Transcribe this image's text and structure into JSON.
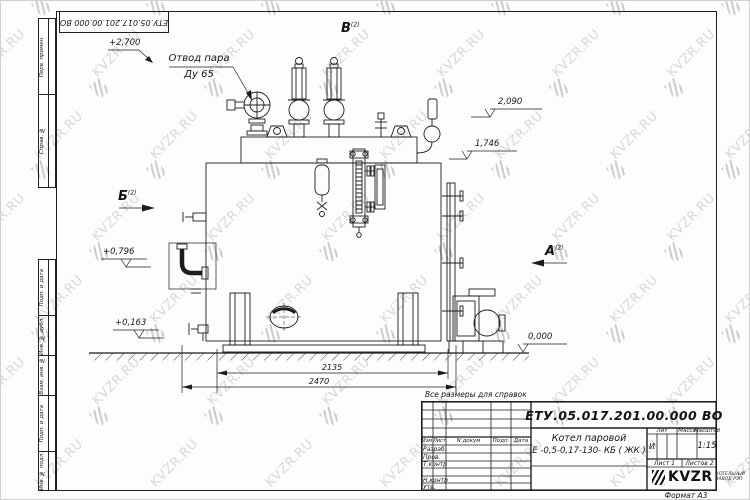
{
  "watermark": {
    "text": "KVZR.RU"
  },
  "stamp_top_box": {
    "number": "ЕТУ.05.017.201.00.000  ВО"
  },
  "side_fields": {
    "top": [
      "Перв. примен.",
      "Справ. №"
    ],
    "bottom": [
      "Подп. и дата",
      "Инв. № дубл.",
      "Взам. инв. №",
      "Подп. и дата",
      "Инв. № подл."
    ]
  },
  "annotations": {
    "steam_outlet_line1": "Отвод пара",
    "steam_outlet_line2": "Ду 65",
    "view_v": "В",
    "view_b": "Б",
    "view_a": "А",
    "view_sheet_ref": "(2)",
    "elev_2700": "+2,700",
    "elev_2090": "2,090",
    "elev_1746": "1,746",
    "elev_0796": "+0,796",
    "elev_0163": "+0,163",
    "elev_0000": "0,000",
    "dim_2135": "2135",
    "dim_2470": "2470",
    "ref_note": "Все размеры для справок"
  },
  "title_block": {
    "doc_number": "ЕТУ.05.017.201.00.000  ВО",
    "product_name_line1": "Котел паровой",
    "product_name_line2": "Е -0,5-0,17-130- КБ ( ЖК )",
    "col_izm": "Изм",
    "col_list": "Лист",
    "col_ndoc": "N докум",
    "col_podp": "Подп.",
    "col_data": "Дата",
    "rows": [
      "Разраб.",
      "Пров.",
      "Т.контр",
      "",
      "Н.контр",
      "Утв."
    ],
    "lit_label": "Лит",
    "massa_label": "Масса",
    "masshtab_label": "Масштаб",
    "lit_value": "И",
    "scale_value": "1:15",
    "sheet_label": "Лист 1",
    "sheets_label": "Листов 2",
    "logo_text": "KVZR",
    "logo_sub1": "КОТЕЛЬНЫЙ",
    "logo_sub2": "ЗАВОД РЭП",
    "format_label": "Формат А3"
  }
}
